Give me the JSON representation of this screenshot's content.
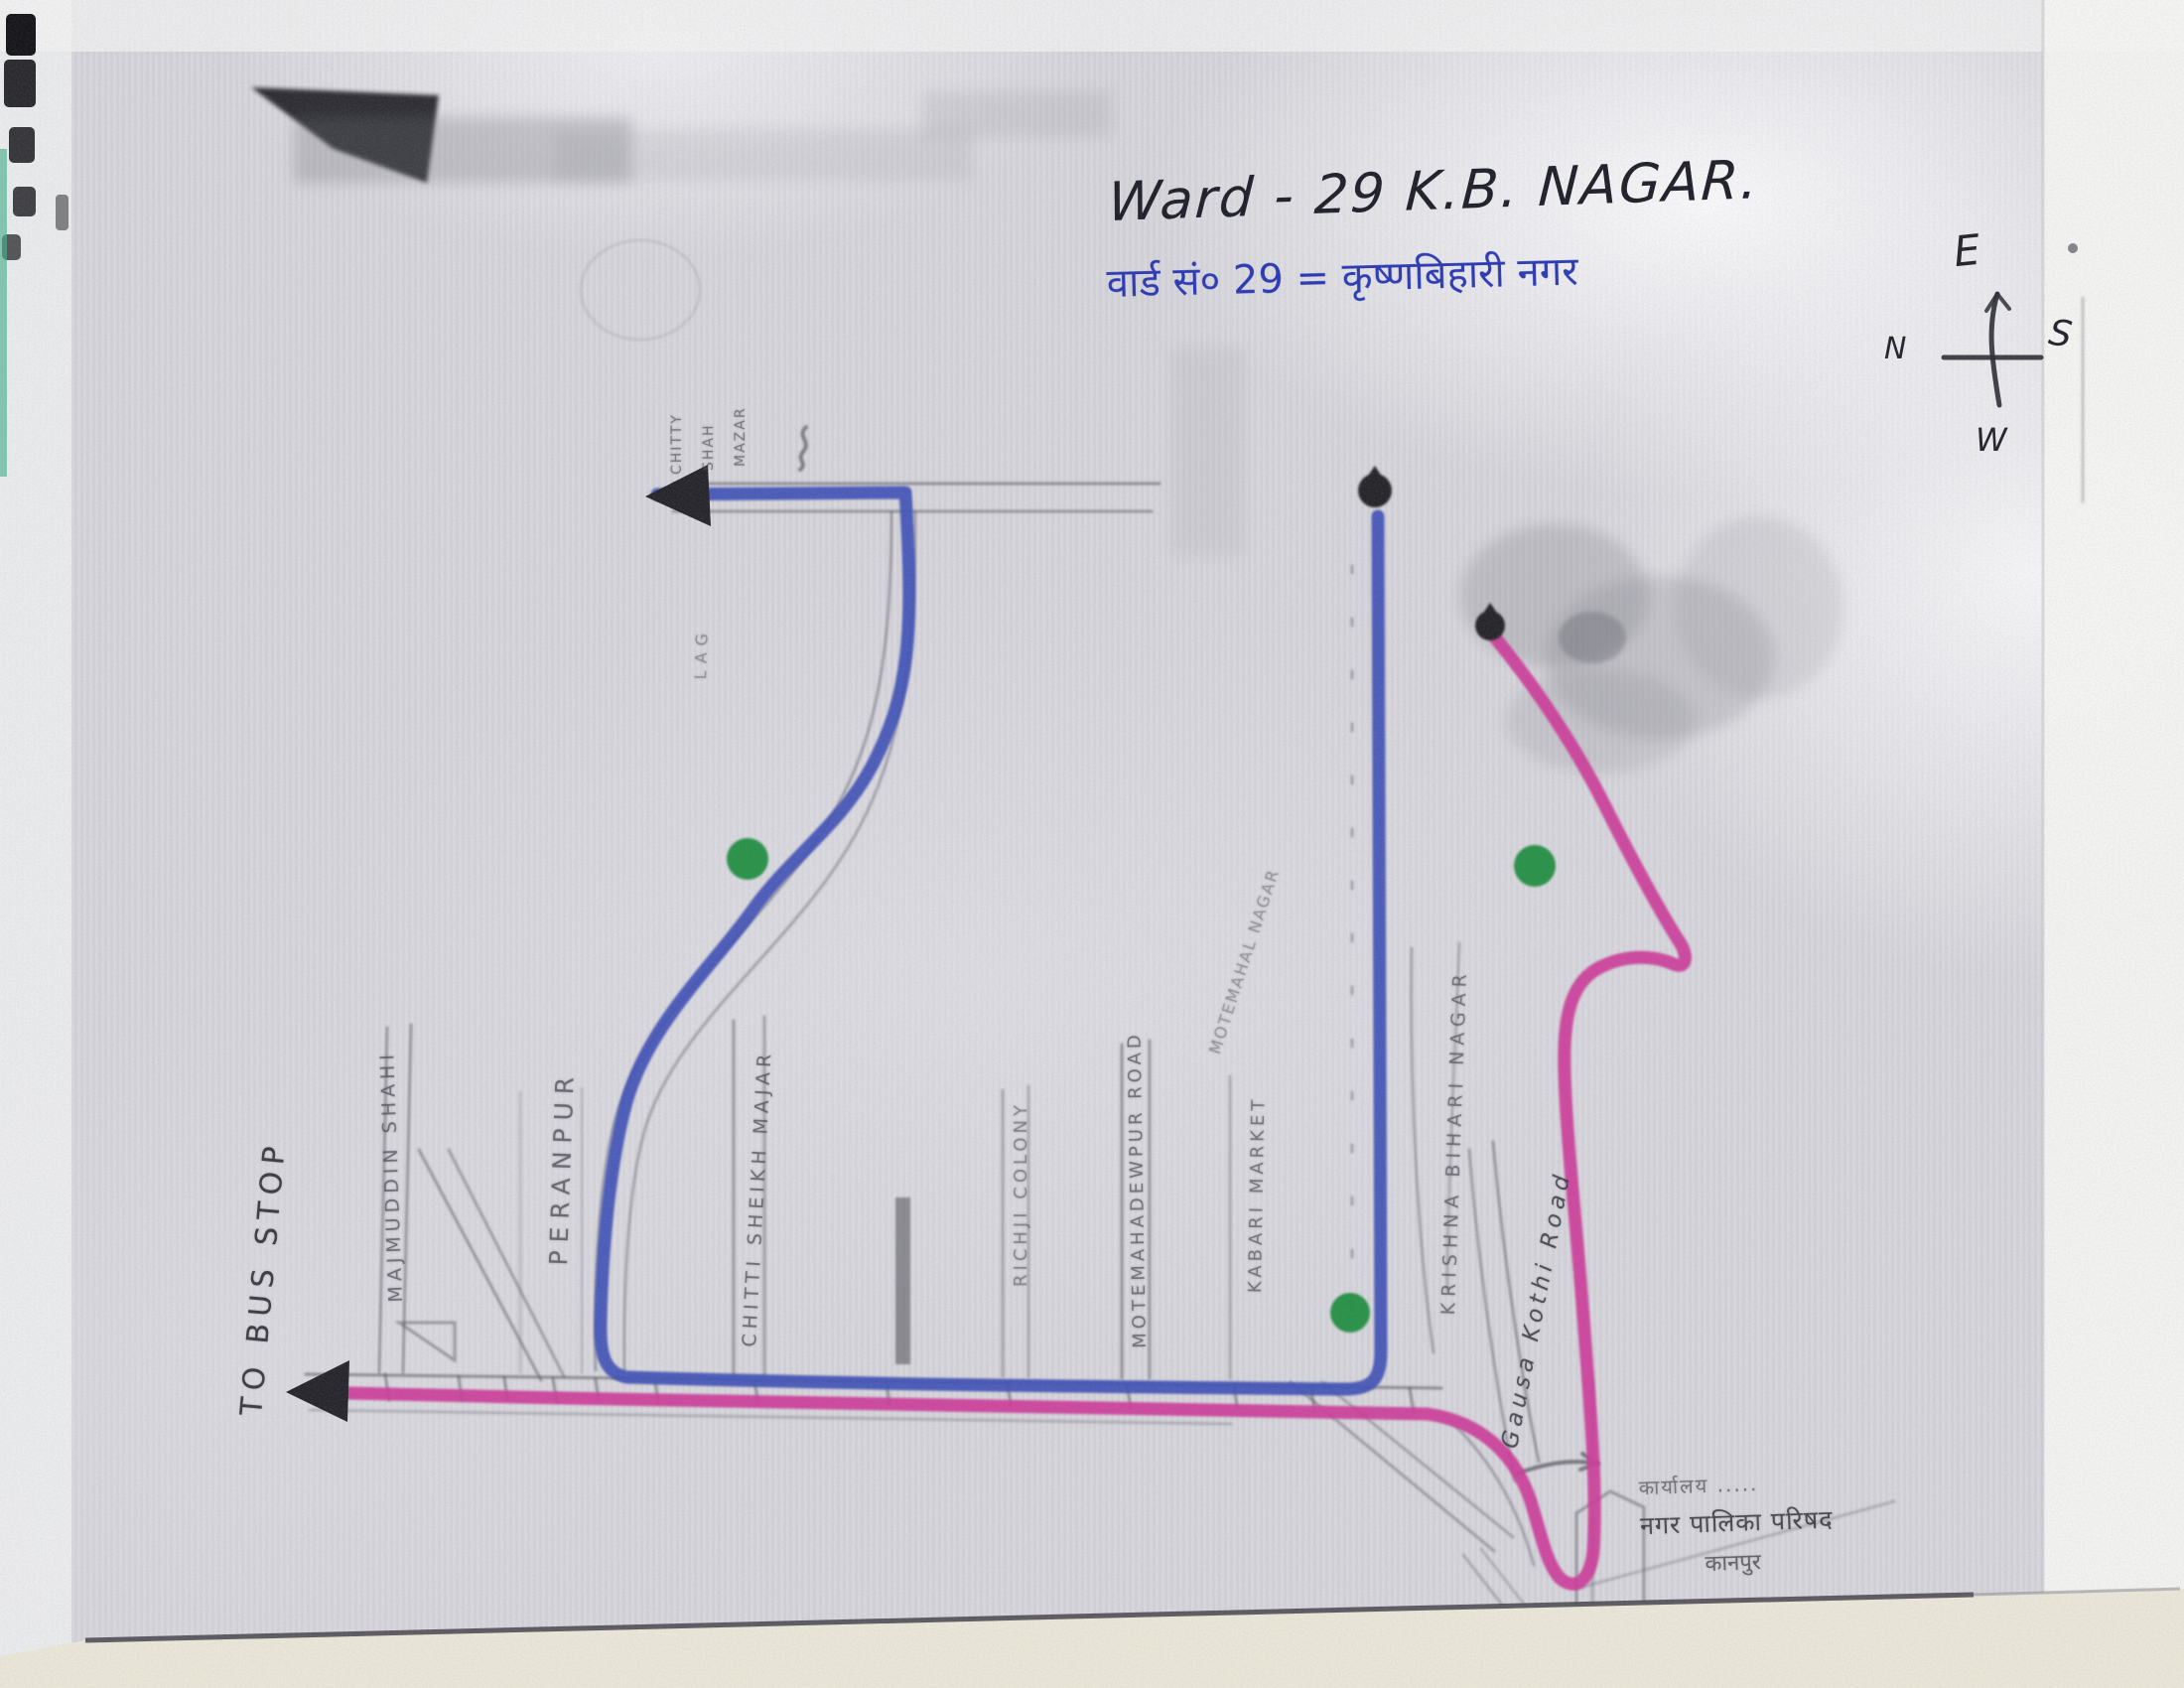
{
  "document": {
    "title_en": "Ward - 29  K.B. NAGAR.",
    "title_hi": "वार्ड सं० 29 = कृष्णबिहारी नगर"
  },
  "compass": {
    "top": "E",
    "left": "N",
    "right": "S",
    "bottom": "W"
  },
  "labels": {
    "to_bus_stop": "TO BUS STOP",
    "majmuddin_shahi": "MAJMUDDIN SHAHI",
    "peranpur": "PERANPUR",
    "chitti_sheikh_majar": "CHITTI SHEIKH MAJAR",
    "richji_colony": "RICHJI COLONY",
    "motemahadewpur_road": "MOTEMAHADEWPUR ROAD",
    "kabari_market": "KABARI MARKET",
    "motemahal_nagar": "MOTEMAHAL NAGAR",
    "krishna_bihari_nagar": "KRISHNA BIHARI NAGAR",
    "gausa_kothi_road": "Gausa Kothi Road",
    "chitty": "CHITTY",
    "shah": "SHAH",
    "mazar": "MAZAR",
    "fragment_lag": "LAG"
  },
  "note": {
    "line1": "कार्यालय .....",
    "line2": "नगर पालिका परिषद",
    "line3": "कानपुर"
  },
  "colors": {
    "route_blue": "#4253b6",
    "route_pink": "#cc3e9a",
    "marker_green": "#1f8c3c",
    "marker_black": "#26262c"
  }
}
